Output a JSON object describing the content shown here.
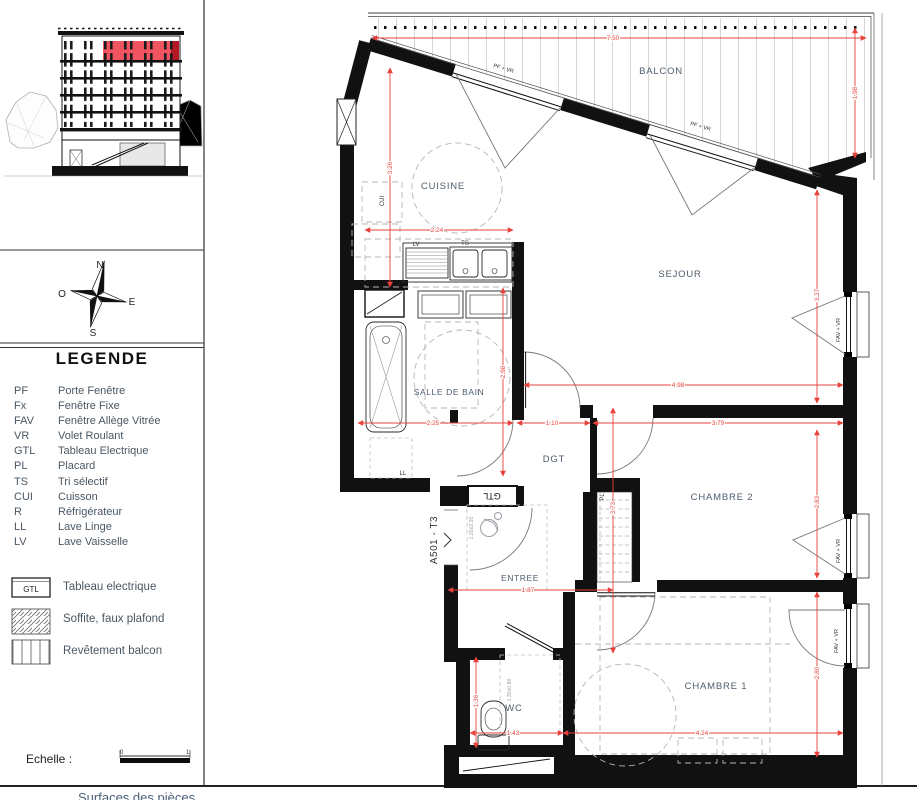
{
  "sheet": {
    "apartment_label": "A501 - T3",
    "footer_partial": "Surfaces des pièces"
  },
  "sidebar": {
    "legend_title": "LEGENDE",
    "legend_items": [
      {
        "abbr": "PF",
        "label": "Porte Fenêtre"
      },
      {
        "abbr": "Fx",
        "label": "Fenêtre Fixe"
      },
      {
        "abbr": "FAV",
        "label": "Fenêtre Allège Vitrée"
      },
      {
        "abbr": "VR",
        "label": "Volet Roulant"
      },
      {
        "abbr": "GTL",
        "label": "Tableau Electrique"
      },
      {
        "abbr": "PL",
        "label": "Placard"
      },
      {
        "abbr": "TS",
        "label": "Tri sélectif"
      },
      {
        "abbr": "CUI",
        "label": "Cuisson"
      },
      {
        "abbr": "R",
        "label": "Réfrigérateur"
      },
      {
        "abbr": "LL",
        "label": "Lave Linge"
      },
      {
        "abbr": "LV",
        "label": "Lave Vaisselle"
      }
    ],
    "symbols": [
      {
        "box": "GTL",
        "label": "Tableau electrique"
      },
      {
        "label": "Soffite, faux plafond"
      },
      {
        "label": "Revêtement balcon"
      }
    ],
    "scale_label": "Echelle :",
    "scale_start": "0",
    "scale_end": "1",
    "compass": {
      "north": "N",
      "south": "S",
      "east": "E",
      "west": "O"
    }
  },
  "plan": {
    "rooms": {
      "balcon": "BALCON",
      "cuisine": "CUISINE",
      "sejour": "SEJOUR",
      "sdb": "SALLE DE BAIN",
      "dgt": "DGT",
      "entree": "ENTREE",
      "chambre2": "CHAMBRE 2",
      "wc": "WC",
      "chambre1": "CHAMBRE 1"
    },
    "labels": {
      "pf_vr": "PF + VR",
      "fav_vr": "FAV + VR",
      "gtl": "GTL",
      "pl": "PL",
      "lv": "LV",
      "ts": "TS",
      "cui": "CUI",
      "ll": "LL",
      "door_clearance": "1.20x2.20",
      "wc_clearance": "1.30x0.80"
    },
    "dims": {
      "balcony_w": "7.50",
      "balcony_d": "1.98",
      "kitchen_w": "2.24",
      "kitchen_h": "3.26",
      "bath_w": "2.25",
      "bath_h": "2.98",
      "dgt_w": "1.10",
      "sejour_w": "4.98",
      "sejour_h": "3.37",
      "ch2_w": "3.79",
      "ch2_h": "2.83",
      "hall_h": "3.73",
      "hall_w": "1.87",
      "wc_w": "1.43",
      "wc_h": "1.36",
      "ch1_w": "4.24",
      "ch1_h": "2.80"
    }
  },
  "colors": {
    "dimension": "#e8413c",
    "wall": "#111111",
    "room_label": "#4e5d6e",
    "elevation_highlight": "#ef5460"
  }
}
